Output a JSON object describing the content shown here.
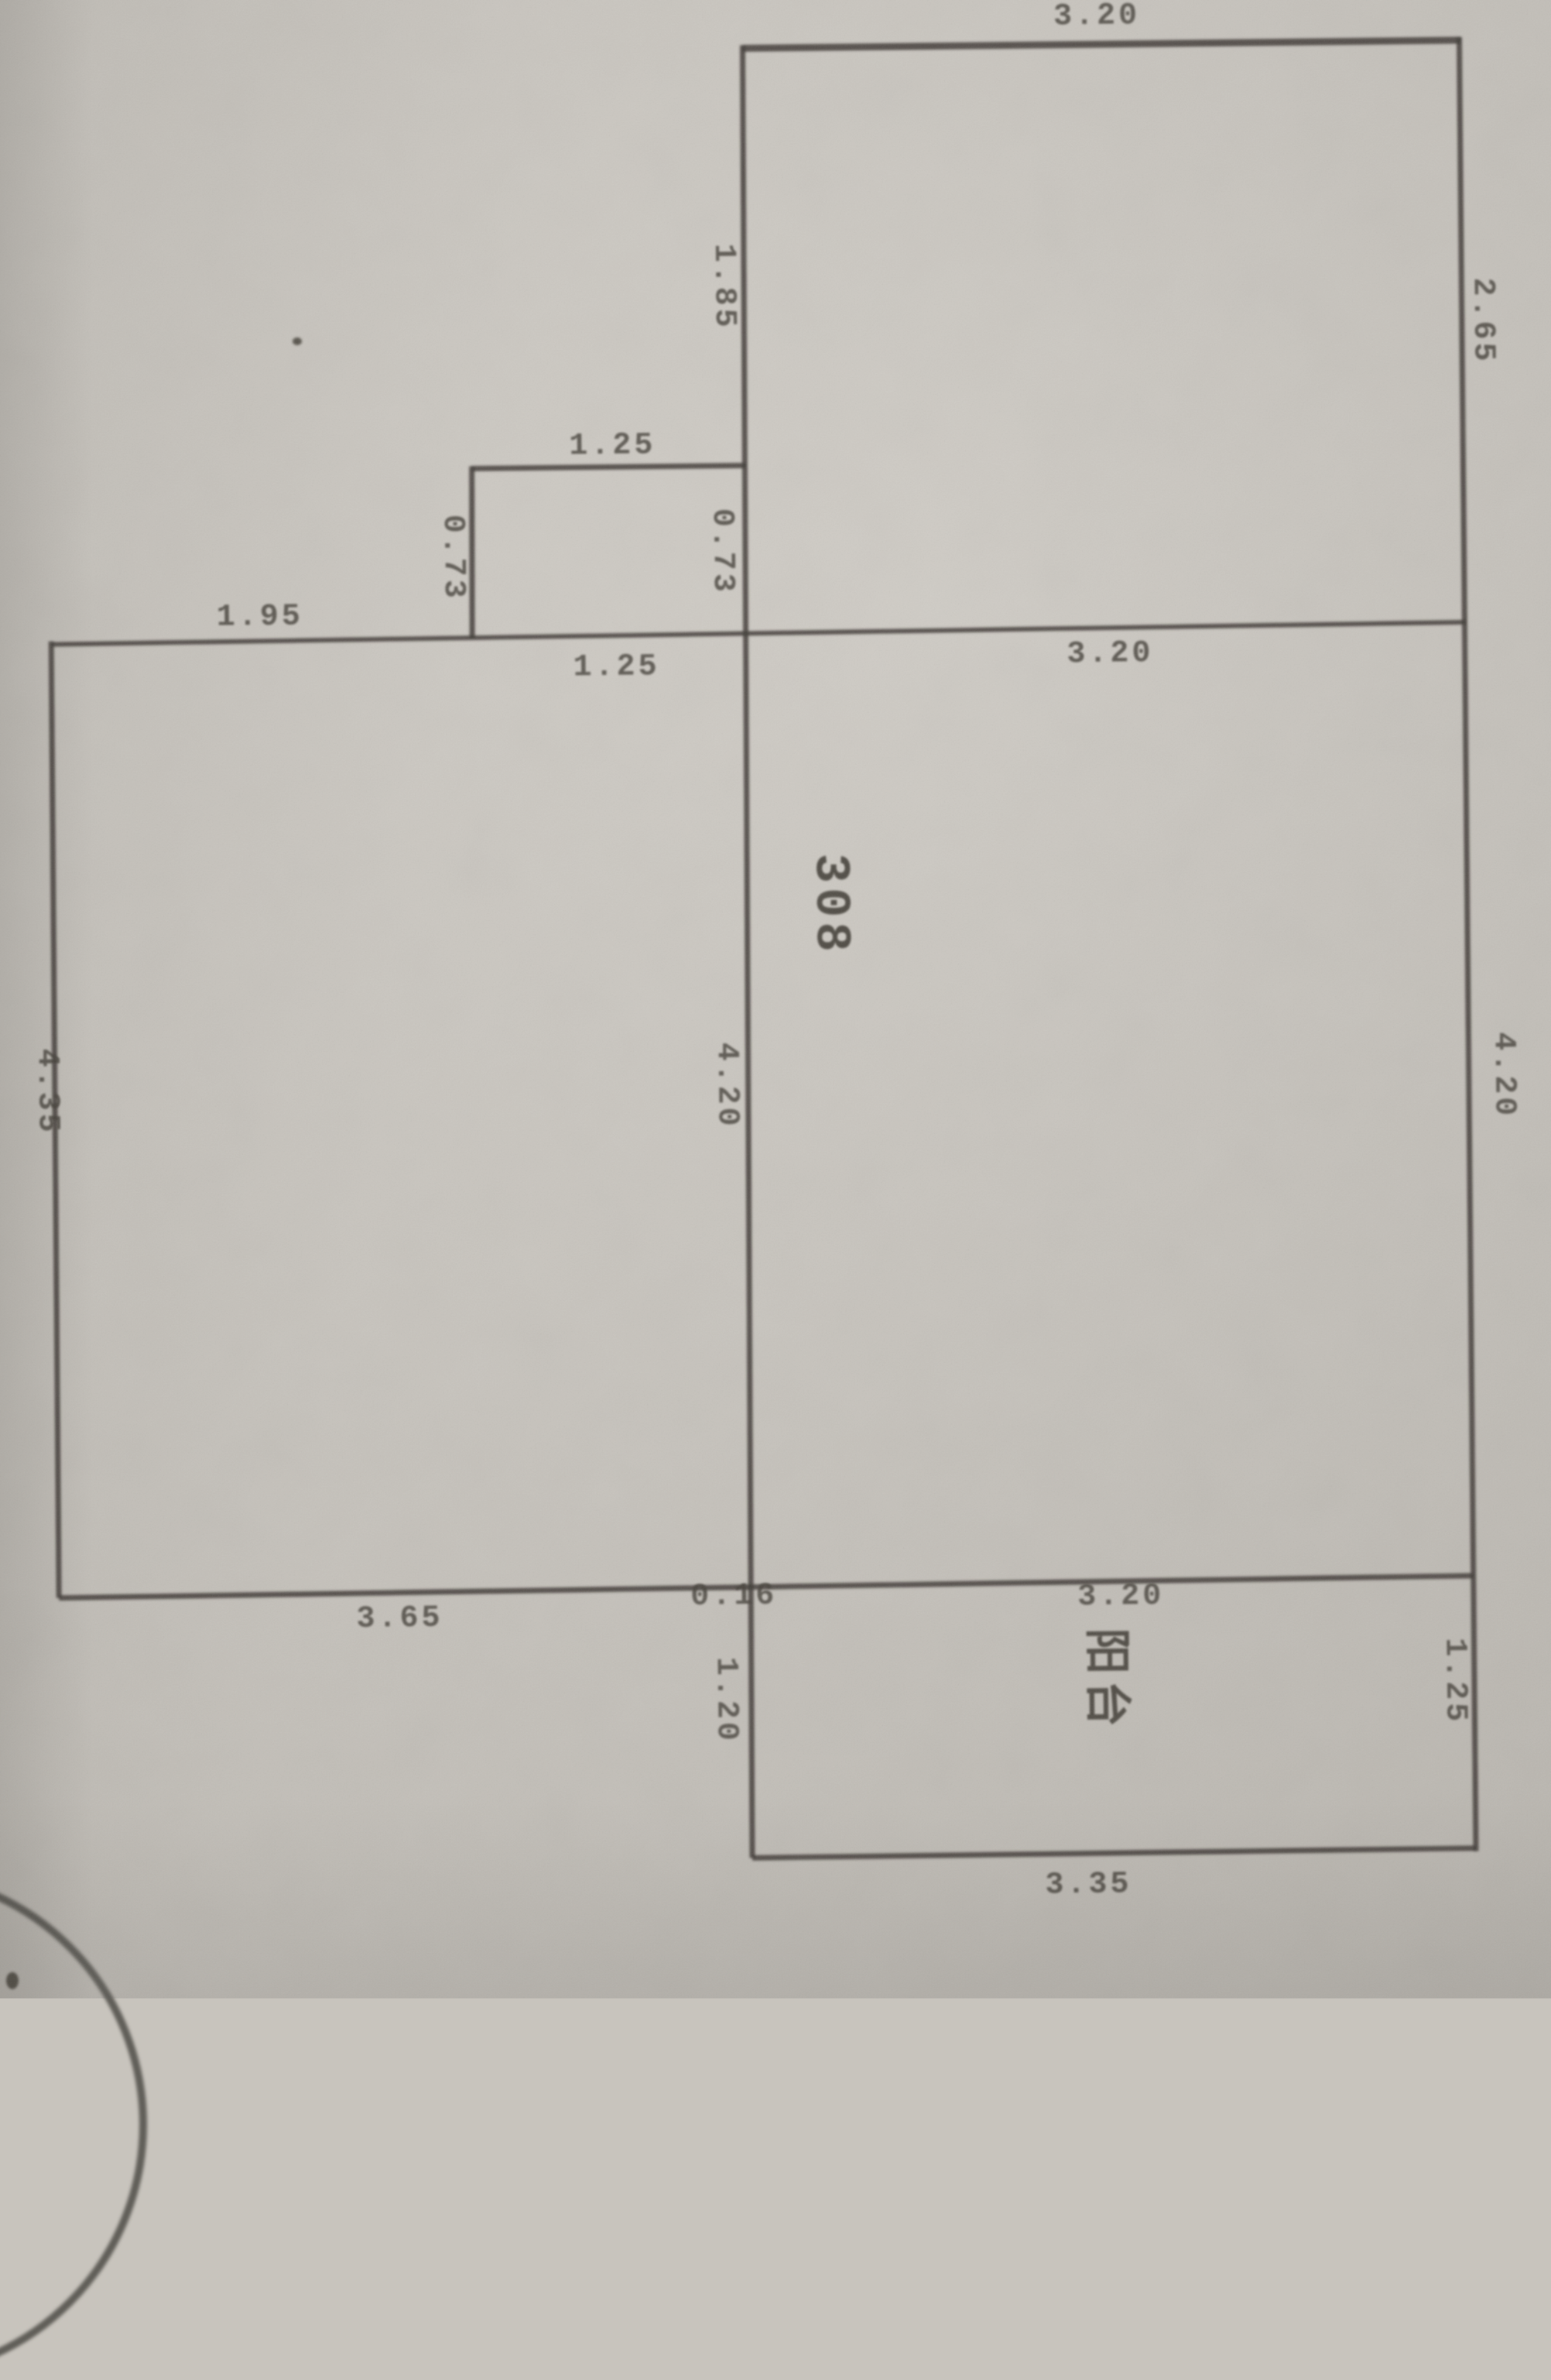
{
  "colors": {
    "paper": "#c8c4bd",
    "ink": "#45413a",
    "wall": "#3e3b35"
  },
  "room": {
    "number": "308",
    "balcony_label": "阳台"
  },
  "dims": {
    "top_width": "3.20",
    "upper_left_height": "1.85",
    "upper_right_height": "2.65",
    "step_top_width": "1.25",
    "step_left_height": "0.73",
    "step_right_height": "0.73",
    "main_left_width": "1.95",
    "main_mid_width": "1.25",
    "main_right_width": "3.20",
    "left_room_height": "4.35",
    "mid_height": "4.20",
    "right_height": "4.20",
    "bottom_left_width": "3.65",
    "bottom_gap": "0.16",
    "bottom_mid_width": "3.20",
    "balcony_left_depth": "1.20",
    "balcony_right_depth": "1.25",
    "balcony_bottom_width": "3.35"
  }
}
